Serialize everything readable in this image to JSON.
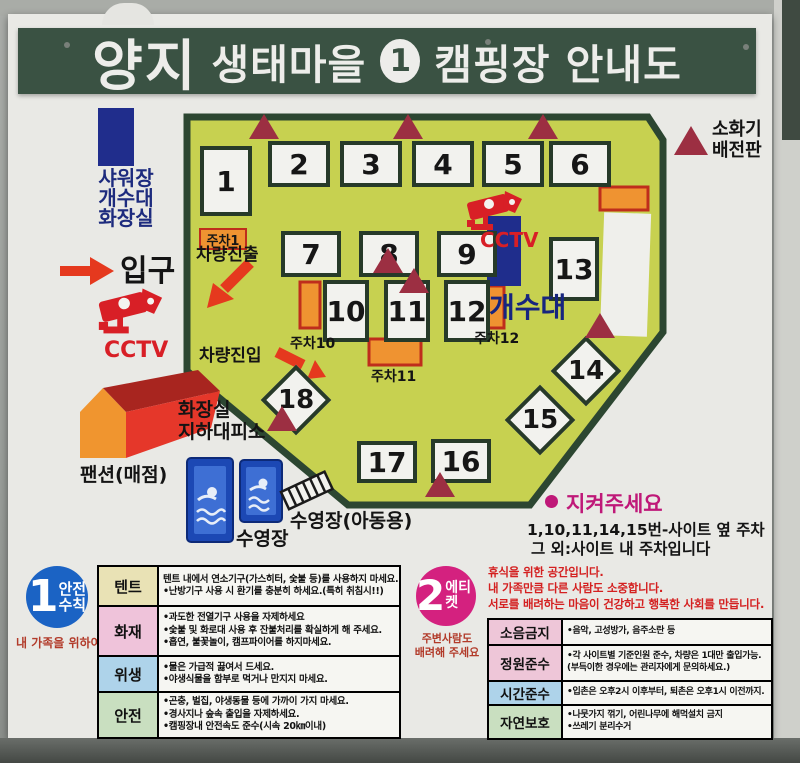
{
  "title": {
    "logo": "양지",
    "text1": "생태마을",
    "badge": "1",
    "text2": "캠핑장 안내도"
  },
  "legend": {
    "facility_line1": "샤워장",
    "facility_line2": "개수대",
    "facility_line3": "화장실",
    "entrance_label": "입구",
    "cctv_label": "CCTV",
    "shelter_line1": "화장실",
    "shelter_line2": "지하대피소",
    "pension_label": "팬션(매점)",
    "pool_label": "수영장",
    "pool_kids_label": "수영장(아동용)",
    "fire_line1": "소화기",
    "fire_line2": "배전판"
  },
  "map": {
    "sites": [
      "1",
      "2",
      "3",
      "4",
      "5",
      "6",
      "7",
      "8",
      "9",
      "10",
      "11",
      "12",
      "13",
      "14",
      "15",
      "16",
      "17",
      "18"
    ],
    "parking1": "주차1",
    "parking10": "주차10",
    "parking11": "주차11",
    "parking12": "주차12",
    "exit_label": "차량진출",
    "entry_label": "차량진입",
    "cctv_label": "CCTV",
    "sink_label": "개수대"
  },
  "notice": {
    "title": "지켜주세요",
    "line1": "1,10,11,14,15번-사이트 옆 주차",
    "line2": "그 외:사이트 내 주차입니다"
  },
  "safety": {
    "number": "1",
    "title_line1": "안전",
    "title_line2": "수칙",
    "subtitle": "내 가족을 위하여",
    "rows": [
      {
        "label": "텐트",
        "lines": [
          "텐트 내에서 연소기구(가스히터, 숯불 등)를 사용하지 마세요.",
          "•난방기구 사용 시 환기를 충분히 하세요.(특히 취침시!!)"
        ]
      },
      {
        "label": "화재",
        "lines": [
          "•과도한 전열기구 사용을 자제하세요",
          "•숯불 및 화로대 사용 후 잔불처리를 확실하게 해 주세요.",
          "•흡연, 불꽃놀이, 캠프파이어를 하지마세요."
        ]
      },
      {
        "label": "위생",
        "lines": [
          "•물은 가급적 끓여서 드세요.",
          "•야생식물을 함부로 먹거나 만지지 마세요."
        ]
      },
      {
        "label": "안전",
        "lines": [
          "•곤충, 벌집, 야생동물 등에 가까이 가지 마세요.",
          "•경사지나 숲속 출입을 자제하세요.",
          "•캠핑장내 안전속도 준수(시속 20㎞이내)"
        ]
      }
    ]
  },
  "etiquette": {
    "number": "2",
    "title": "에티켓",
    "subtitle_line1": "주변사람도",
    "subtitle_line2": "배려해 주세요",
    "intro_lines": [
      "휴식을 위한 공간입니다.",
      "내 가족만큼 다른 사람도 소중합니다.",
      "서로를 배려하는 마음이 건강하고 행복한 사회를 만듭니다."
    ],
    "rows": [
      {
        "label": "소음금지",
        "lines": [
          "•음악, 고성방가, 음주소란 등"
        ]
      },
      {
        "label": "정원준수",
        "lines": [
          "•각 사이트별 기준인원 준수, 차량은 1대만 출입가능.",
          "(부득이한 경우에는 관리자에게 문의하세요.)"
        ]
      },
      {
        "label": "시간준수",
        "lines": [
          "•입촌은 오후2시 이후부터, 퇴촌은 오후1시 이전까지."
        ]
      },
      {
        "label": "자연보호",
        "lines": [
          "•나뭇가지 꺾기, 어린나무에 해먹설치 금지",
          "•쓰레기 분리수거"
        ]
      }
    ]
  },
  "colors": {
    "map_bg": "#c7d150",
    "map_border": "#2c4631",
    "marker_red": "#9c2f42",
    "parking_orange": "#ef9331",
    "parking_border": "#bf2d1c",
    "arrow_red": "#e5391e",
    "cctv_red": "#d81f26",
    "sink_blue": "#1f2d8c",
    "notice_magenta": "#bf1878",
    "safety_blue": "#1b63c4",
    "etiquette_pink": "#d4217f",
    "header_green": "#3a5243"
  }
}
